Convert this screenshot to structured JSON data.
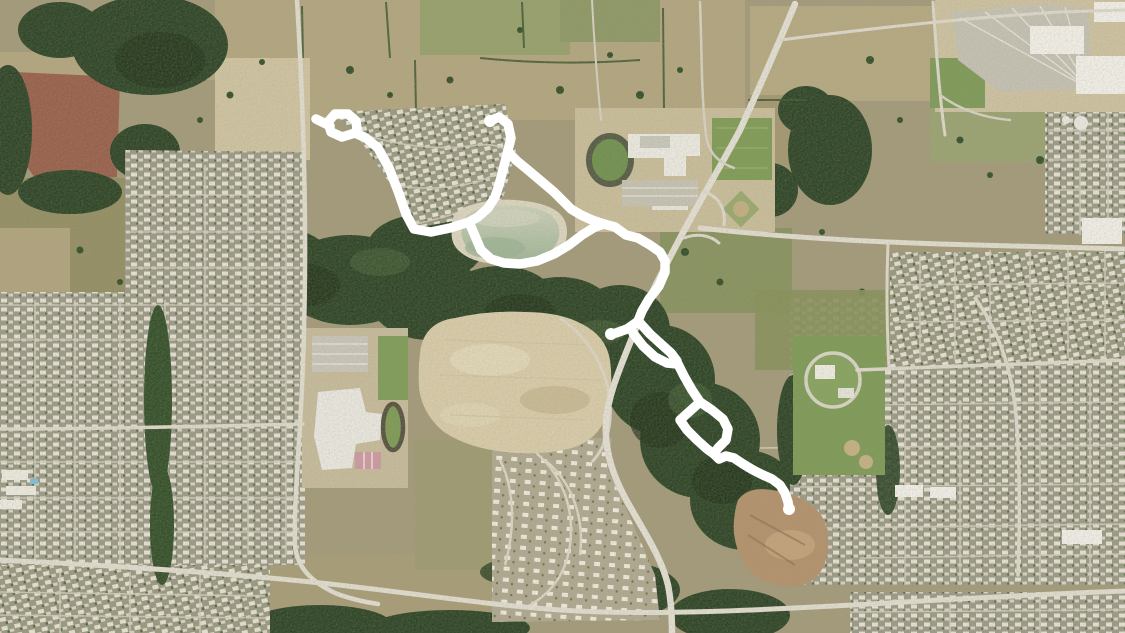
{
  "map": {
    "kind": "satellite-aerial-imagery",
    "scene": "Aerial view of a suburban/rural fringe: farm fields and forest bands, dense housing subdivisions, two school campuses with running tracks, a highway curving through the middle, a pond, cleared construction sites, and a white GPS activity route overlay",
    "visible_text": []
  },
  "route": {
    "color": "#ffffff",
    "stroke_width": 9.5,
    "cap_radius": 6,
    "paths": [
      [
        [
          490,
          121
        ],
        [
          499,
          117
        ],
        [
          508,
          124
        ],
        [
          511,
          138
        ],
        [
          507,
          154
        ],
        [
          503,
          170
        ],
        [
          499,
          185
        ],
        [
          495,
          197
        ],
        [
          488,
          208
        ],
        [
          478,
          217
        ],
        [
          469,
          222
        ]
      ],
      [
        [
          469,
          222
        ],
        [
          450,
          228
        ],
        [
          431,
          232
        ],
        [
          414,
          229
        ],
        [
          406,
          214
        ],
        [
          398,
          191
        ],
        [
          389,
          168
        ],
        [
          378,
          148
        ],
        [
          366,
          138
        ],
        [
          355,
          133
        ]
      ],
      [
        [
          355,
          133
        ],
        [
          342,
          137
        ],
        [
          331,
          132
        ],
        [
          328,
          122
        ],
        [
          335,
          114
        ],
        [
          348,
          114
        ],
        [
          356,
          121
        ],
        [
          357,
          129
        ],
        [
          355,
          133
        ]
      ],
      [
        [
          330,
          126
        ],
        [
          316,
          119
        ]
      ],
      [
        [
          469,
          222
        ],
        [
          475,
          236
        ],
        [
          481,
          250
        ],
        [
          491,
          259
        ],
        [
          504,
          263
        ],
        [
          520,
          264
        ],
        [
          537,
          261
        ],
        [
          554,
          254
        ],
        [
          569,
          245
        ],
        [
          582,
          235
        ],
        [
          595,
          227
        ],
        [
          604,
          224
        ]
      ],
      [
        [
          508,
          152
        ],
        [
          517,
          161
        ],
        [
          528,
          170
        ],
        [
          541,
          181
        ],
        [
          554,
          192
        ],
        [
          564,
          202
        ],
        [
          571,
          209
        ],
        [
          581,
          215
        ],
        [
          592,
          220
        ],
        [
          604,
          224
        ]
      ],
      [
        [
          604,
          224
        ],
        [
          615,
          227
        ],
        [
          626,
          235
        ],
        [
          638,
          238
        ],
        [
          650,
          245
        ],
        [
          660,
          252
        ],
        [
          665,
          261
        ],
        [
          665,
          272
        ],
        [
          659,
          286
        ],
        [
          649,
          299
        ],
        [
          642,
          311
        ],
        [
          638,
          321
        ]
      ],
      [
        [
          637,
          322
        ],
        [
          627,
          329
        ],
        [
          616,
          333
        ],
        [
          611,
          334
        ]
      ],
      [
        [
          640,
          323
        ],
        [
          650,
          334
        ],
        [
          661,
          344
        ],
        [
          671,
          353
        ],
        [
          677,
          361
        ]
      ],
      [
        [
          633,
          333
        ],
        [
          643,
          346
        ],
        [
          655,
          357
        ],
        [
          667,
          363
        ],
        [
          677,
          364
        ]
      ],
      [
        [
          677,
          362
        ],
        [
          684,
          376
        ],
        [
          692,
          390
        ],
        [
          700,
          402
        ]
      ],
      [
        [
          700,
          402
        ],
        [
          690,
          411
        ],
        [
          680,
          420
        ],
        [
          687,
          430
        ],
        [
          697,
          440
        ],
        [
          707,
          449
        ],
        [
          714,
          454
        ]
      ],
      [
        [
          700,
          402
        ],
        [
          712,
          410
        ],
        [
          723,
          419
        ],
        [
          728,
          429
        ],
        [
          726,
          440
        ],
        [
          718,
          448
        ],
        [
          714,
          454
        ]
      ],
      [
        [
          714,
          454
        ],
        [
          719,
          459
        ],
        [
          726,
          456
        ],
        [
          734,
          458
        ],
        [
          743,
          464
        ],
        [
          753,
          470
        ],
        [
          763,
          475
        ],
        [
          772,
          479
        ],
        [
          780,
          485
        ],
        [
          785,
          493
        ],
        [
          788,
          502
        ],
        [
          789,
          509
        ]
      ]
    ],
    "endpoint_caps": [
      [
        490,
        121
      ],
      [
        611,
        334
      ],
      [
        789,
        509
      ]
    ]
  },
  "palette": {
    "field_tan": "#b2a67e",
    "field_pale": "#cfc3a0",
    "field_olive": "#948e63",
    "field_red_brown": "#98604a",
    "forest_dark": "#2f4526",
    "forest_deep": "#24361b",
    "suburb_base": "#9b9a85",
    "house_light": "#e6e1d3",
    "road_light": "#e0dcce",
    "cleared_dirt": "#d8cba8",
    "pit_brown": "#b3916b",
    "pond_water": "#bdc7ac",
    "lawn_green": "#7f9b55",
    "route_white": "#ffffff"
  }
}
